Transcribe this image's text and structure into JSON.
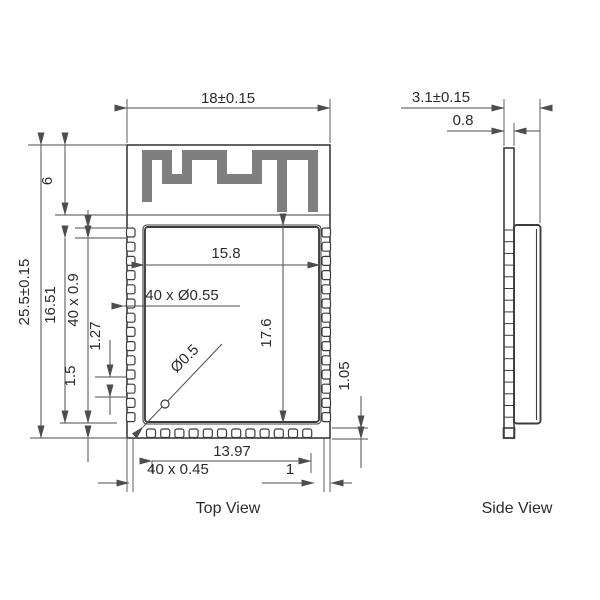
{
  "drawing": {
    "top_view": {
      "label": "Top View",
      "dims": {
        "overall_width": "18±0.15",
        "overall_height": "25.5±0.15",
        "antenna_height": "6",
        "body_height": "16.51",
        "side_pads": "40 x 0.9",
        "pad_pitch": "1.27",
        "pad_edge_gap": "1.5",
        "shield_width": "15.8",
        "castellation_holes": "40 x Ø0.55",
        "shield_height": "17.6",
        "via_diameter": "Ø0.5",
        "right_edge_gap": "1.05",
        "bottom_pad_span": "13.97",
        "bottom_pads": "40 x 0.45",
        "bottom_margin": "1"
      }
    },
    "side_view": {
      "label": "Side View",
      "dims": {
        "overall_thickness": "3.1±0.15",
        "pcb_thickness": "0.8"
      }
    },
    "colors": {
      "line": "#3c3c3c",
      "dimension_line": "#4d4d4d",
      "antenna_trace": "#7f7f7f",
      "text": "#2b2b2b"
    }
  }
}
